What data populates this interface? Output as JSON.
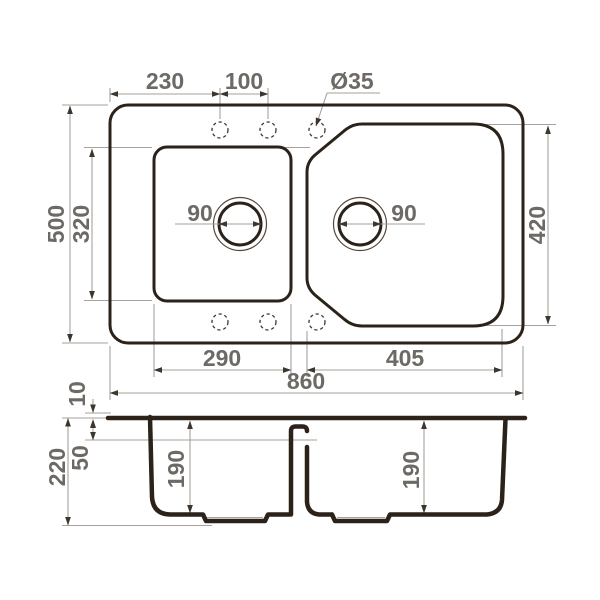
{
  "drawing": {
    "type": "technical-drawing",
    "subject": "double-bowl kitchen sink dimensions",
    "views": {
      "top": {
        "overall_width_mm": "860",
        "overall_depth_mm": "500",
        "left_bowl_width_mm": "290",
        "left_bowl_depth_mm": "320",
        "right_bowl_width_mm": "405",
        "right_bowl_depth_mm": "420",
        "faucet_hole_offset_mm": "230",
        "faucet_hole_spacing_mm": "100",
        "faucet_hole_diameter": "Ø35",
        "left_drain_diameter_mm": "90",
        "right_drain_diameter_mm": "90"
      },
      "section": {
        "rim_height_mm": "10",
        "divider_level_mm": "50",
        "overall_height_mm": "220",
        "left_bowl_inner_depth_mm": "190",
        "right_bowl_inner_depth_mm": "190"
      }
    },
    "colors": {
      "outline": "#2b221a",
      "dimension_line": "#a6a19b",
      "dimension_text": "#6d6a66",
      "arrow": "#3d362f",
      "background": "#ffffff"
    }
  }
}
